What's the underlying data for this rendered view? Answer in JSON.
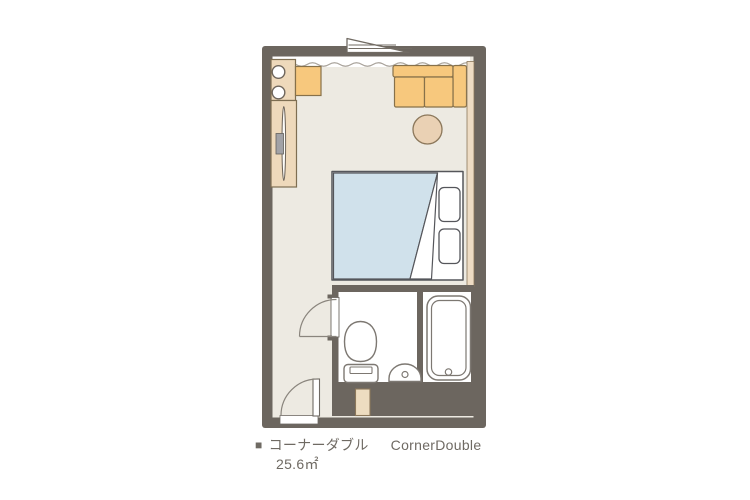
{
  "caption": {
    "bullet": "■",
    "room_name_ja": "コーナーダブル",
    "room_name_en": "CornerDouble",
    "area": "25.6㎡"
  },
  "colors": {
    "wall": "#6c665f",
    "floor": "#edeae2",
    "white": "#ffffff",
    "furniture_beige": "#eed9bb",
    "accent_orange": "#f7c87d",
    "duvet_blue": "#d0e1eb",
    "table_tan": "#ead1b4",
    "fixture_stroke": "#7d7872",
    "bed_stroke": "#55565b",
    "wood_stroke": "#87714a",
    "caption_text": "#6f6a63"
  }
}
